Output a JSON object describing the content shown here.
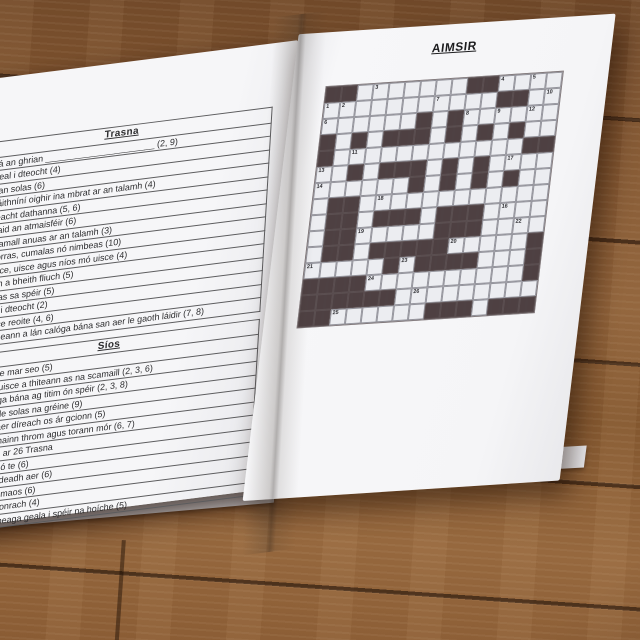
{
  "left_page": {
    "across": {
      "header": "Trasna",
      "clues": [
        {
          "num": "1",
          "text": "Tá an ghrian ______________________ (2, 9)"
        },
        {
          "num": "4",
          "text": "Íseal i dteocht (4)"
        },
        {
          "num": "6",
          "text": "Gan solas (6)"
        },
        {
          "num": "8",
          "text": "Cáithníní oighir ina mbrat ar an talamh (4)"
        },
        {
          "num": "11",
          "text": "Seacht dathanna (5, 6)"
        },
        {
          "num": "14",
          "text": "Staid an atmaisféir (6)"
        },
        {
          "num": "17",
          "text": "Scamall anuas ar an talamh (3)"
        },
        {
          "num": "18",
          "text": "Ciorras, cumalas nó nimbeas (10)"
        },
        {
          "num": "19",
          "text": "Uisce, uisce agus níos mó uisce (4)"
        },
        {
          "num": "20",
          "text": "Gan a bheith fliuch (5)"
        },
        {
          "num": "21",
          "text": "Solas sa spéir (5)"
        },
        {
          "num": "22",
          "text": "Ard i dteocht (2)"
        },
        {
          "num": "24",
          "text": "Uisce reoite (4, 6)"
        },
        {
          "num": "26",
          "text": "Séideann a lán calóga bána san aer le gaoth láidir (7, 8)"
        }
      ]
    },
    "down": {
      "header": "Síos",
      "clues": [
        {
          "num": "2",
          "text": "Imithe mar seo (5)"
        },
        {
          "num": "3",
          "text": "An t-uisce a thiteann as na scamaill (2, 3, 6)"
        },
        {
          "num": "5",
          "text": "Calóga bána ag titim ón spéir (2, 3, 8)"
        },
        {
          "num": "7",
          "text": "Geal le solas na gréine (9)"
        },
        {
          "num": "8",
          "text": "An t-aer díreach os ár gcionn (5)"
        },
        {
          "num": "9",
          "text": "Fearthainn throm agus torann mór (6, 7)"
        },
        {
          "num": "10",
          "text": "Féach ar 26 Trasna"
        },
        {
          "num": "12",
          "text": "Fuar nó te (6)"
        },
        {
          "num": "13",
          "text": "Ag séideadh aer (6)"
        },
        {
          "num": "16",
          "text": "Cur ar maos (6)"
        },
        {
          "num": "23",
          "text": "Solas lonrach (4)"
        },
        {
          "num": "25",
          "text": "Pointí beaga geala i spéir na hoíche (5)"
        }
      ]
    }
  },
  "right_page": {
    "title": "AIMSIR",
    "grid": {
      "legend": "# = dark blocked cell, . = open white cell",
      "rows": [
        "##.......##....",
        "...........##..",
        "......#.#......",
        "#.#.###.#.#.#..",
        "#............##",
        "..#.###.#.#....",
        "......#.#.#.#..",
        ".##............",
        ".##.###.###....",
        ".##.....###....",
        ".##.#####.....#",
        ".....#.####...#",
        "####..........#",
        "######.........",
        "##......###.###"
      ],
      "numbers": {
        "0,3": "3",
        "0,11": "4",
        "0,13": "5",
        "1,0": "1",
        "1,1": "2",
        "1,7": "7",
        "1,14": "10",
        "2,0": "6",
        "2,9": "8",
        "2,11": "9",
        "2,13": "12",
        "4,2": "11",
        "5,0": "13",
        "5,12": "17",
        "6,0": "14",
        "7,4": "18",
        "8,12": "16",
        "9,3": "19",
        "9,13": "22",
        "10,9": "20",
        "11,0": "21",
        "11,6": "23",
        "12,4": "24",
        "13,7": "26",
        "14,2": "25"
      },
      "colors": {
        "block": "#4e4143",
        "open": "#ecedf1"
      }
    }
  }
}
